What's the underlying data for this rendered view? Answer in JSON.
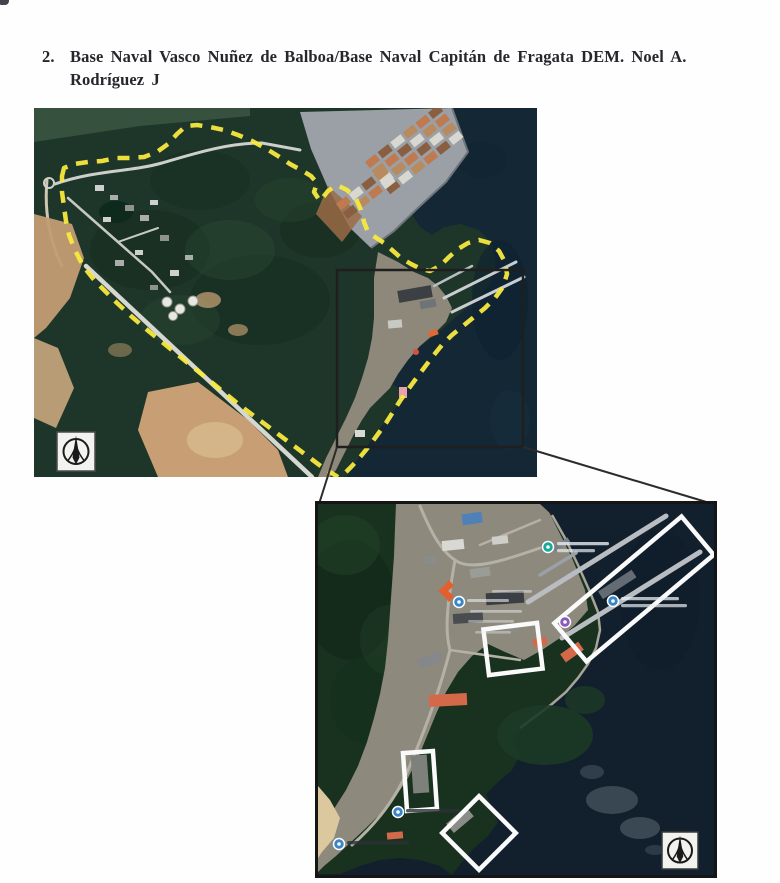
{
  "document": {
    "section_number": "2.",
    "title_line1": "Base Naval Vasco Nuñez de Balboa/Base Naval Capitán de Fragata DEM. Noel A.",
    "title_line2": "Rodríguez J"
  },
  "figure1": {
    "type": "satellite-overview-map",
    "boundary_style": "yellow-dashed-perimeter",
    "boundary_color": "#f8e93e",
    "inset_outline_color": "#1f1f1f",
    "compass_position": "bottom-left"
  },
  "figure2": {
    "type": "satellite-detail-map",
    "frame_color": "#151515",
    "highlight_color": "#fafafa",
    "highlight_count": 4,
    "compass_position": "bottom-right",
    "pins": [
      {
        "id": "pin-teal-top",
        "color": "#18a999"
      },
      {
        "id": "pin-blue-left",
        "color": "#3a86c8"
      },
      {
        "id": "pin-blue-pier",
        "color": "#3a86c8"
      },
      {
        "id": "pin-purple-center",
        "color": "#8a5bbf"
      },
      {
        "id": "pin-blue-lower",
        "color": "#3a86c8"
      },
      {
        "id": "pin-blue-bottom",
        "color": "#3a86c8"
      }
    ]
  },
  "colors": {
    "water": "#12202e",
    "forest": "#1c3425",
    "port_concrete": "#9aa0a5",
    "soil": "#c89f74",
    "heading_text": "#26262c"
  }
}
